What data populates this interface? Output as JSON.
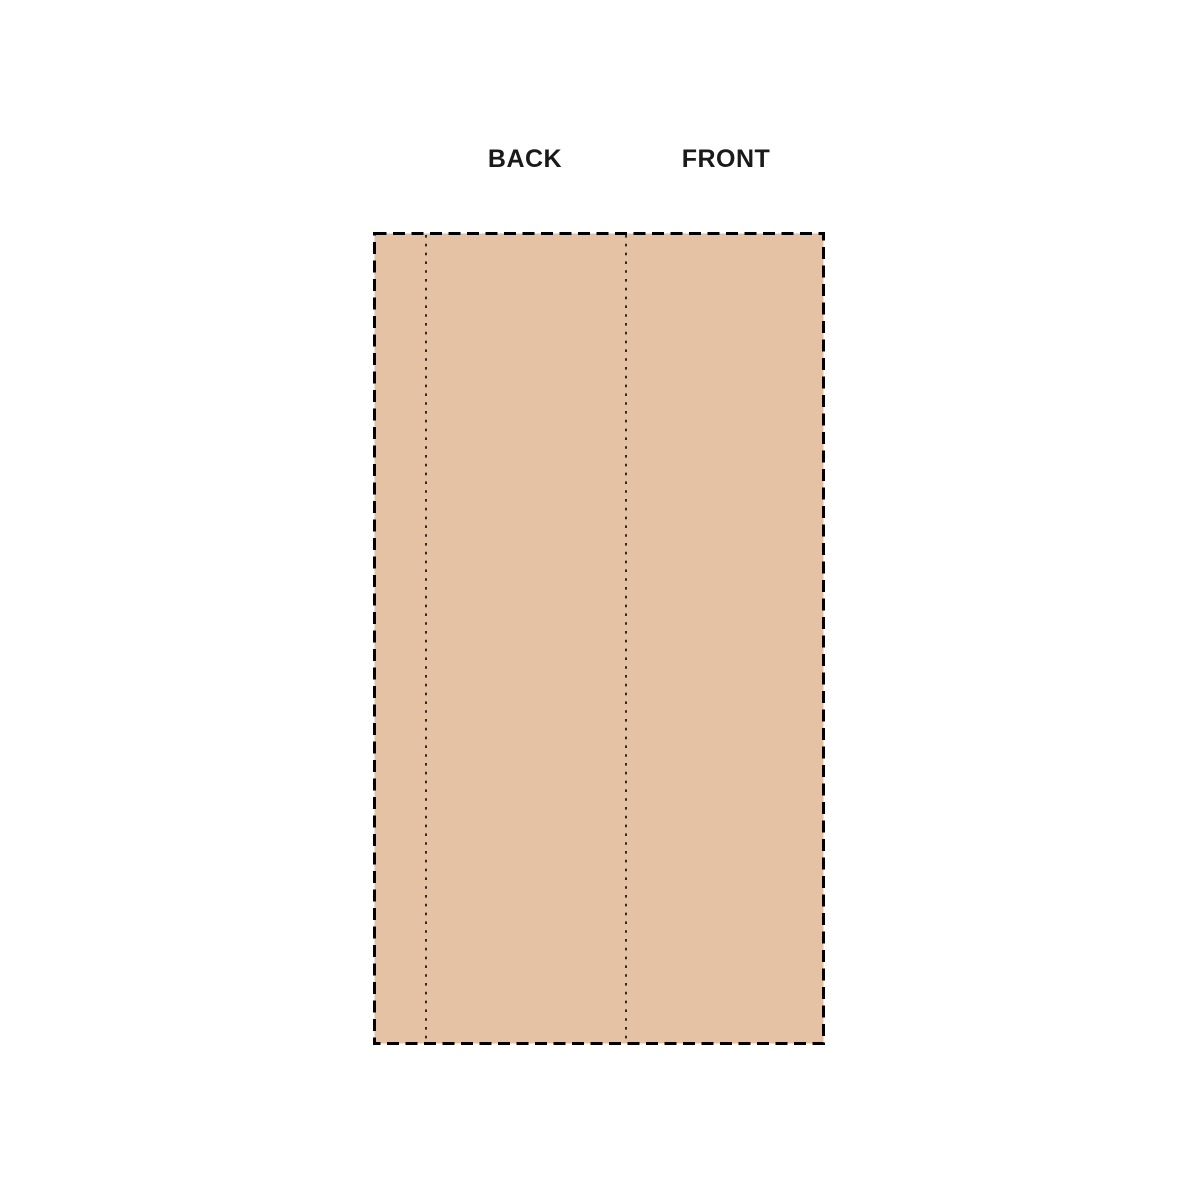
{
  "diagram": {
    "title": "pattern piece with fold lines",
    "background_color": "#ffffff"
  },
  "labels": {
    "back": "BACK",
    "front": "FRONT"
  },
  "pattern": {
    "fill_color": "#e5c2a3",
    "outline_color": "#000000",
    "outline_style": "dashed",
    "fold_line_style": "dotted",
    "fold_line_count": "2"
  }
}
